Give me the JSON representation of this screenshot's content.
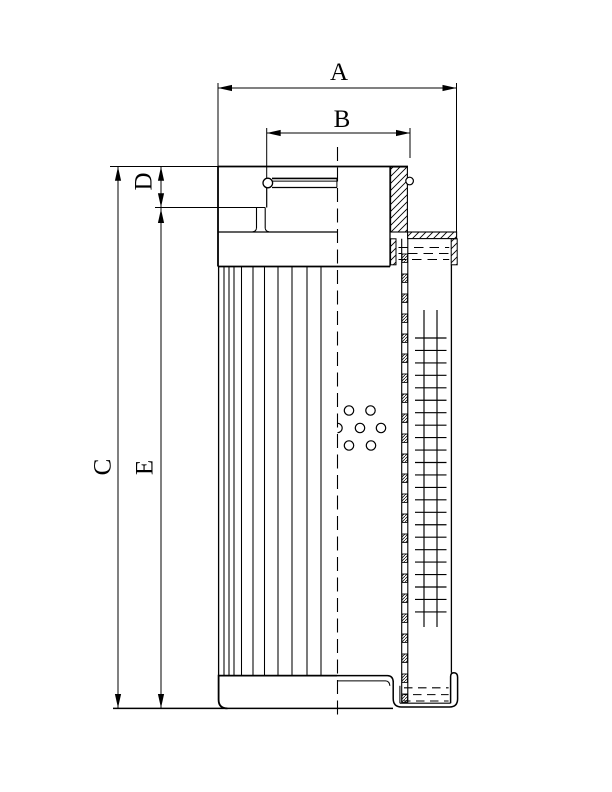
{
  "drawing": {
    "labels": {
      "a": "A",
      "b": "B",
      "c": "C",
      "d": "D",
      "e": "E"
    }
  },
  "colors": {
    "ink": "#000000",
    "paper": "#ffffff"
  }
}
